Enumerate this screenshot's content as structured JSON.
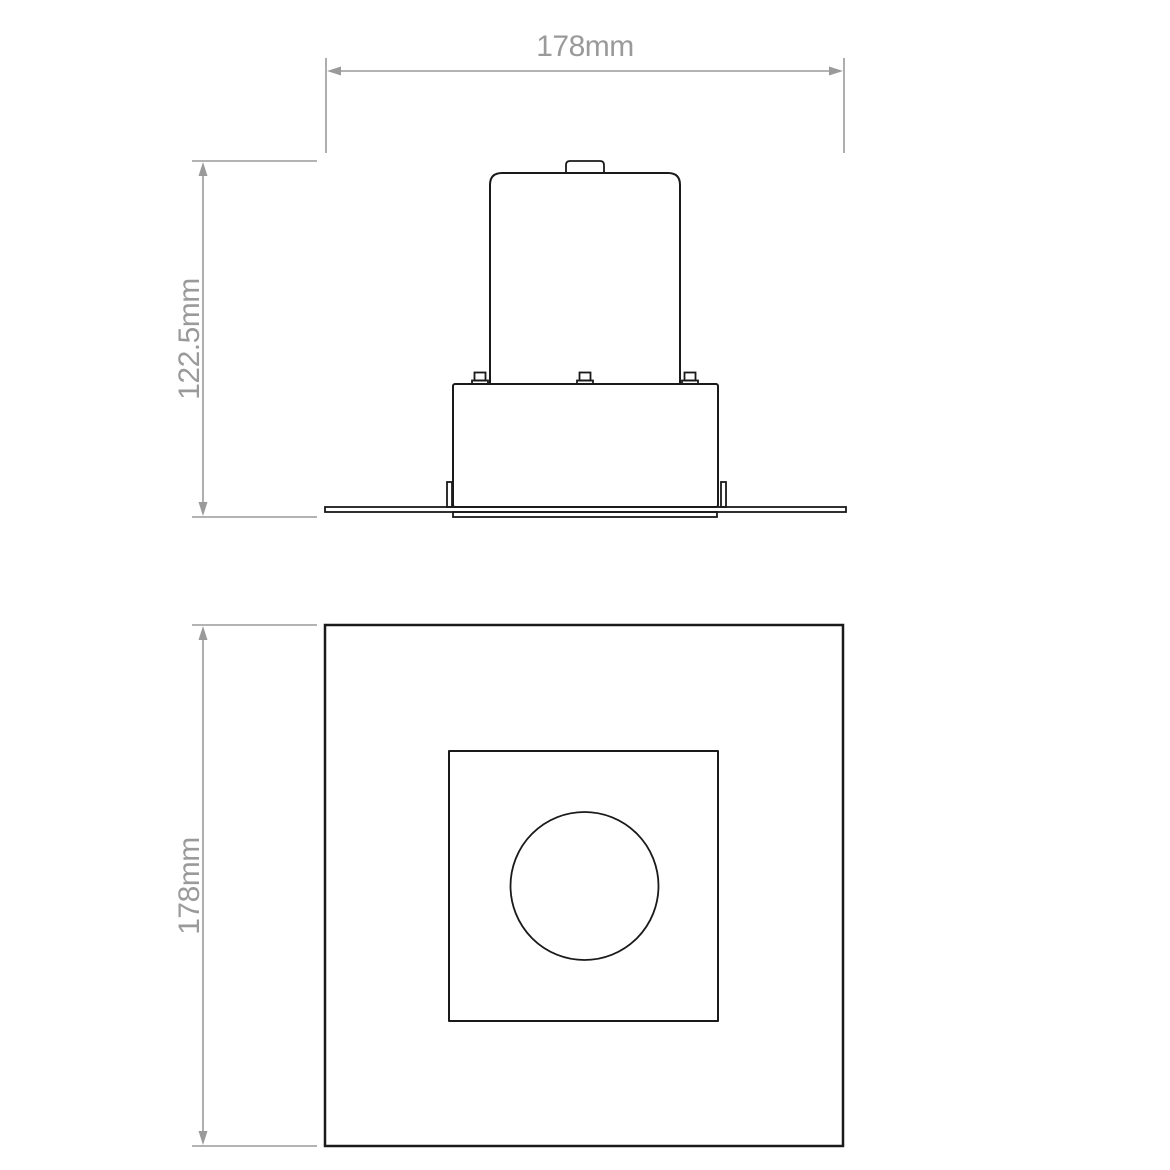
{
  "canvas": {
    "background": "#ffffff"
  },
  "colors": {
    "outline": "#1a1a1a",
    "dimension": "#9a9a9a"
  },
  "views": {
    "front_elevation": {
      "width_dimension": {
        "label": "178mm"
      },
      "height_dimension": {
        "label": "122.5mm"
      }
    },
    "plan": {
      "height_dimension": {
        "label": "178mm"
      }
    }
  }
}
